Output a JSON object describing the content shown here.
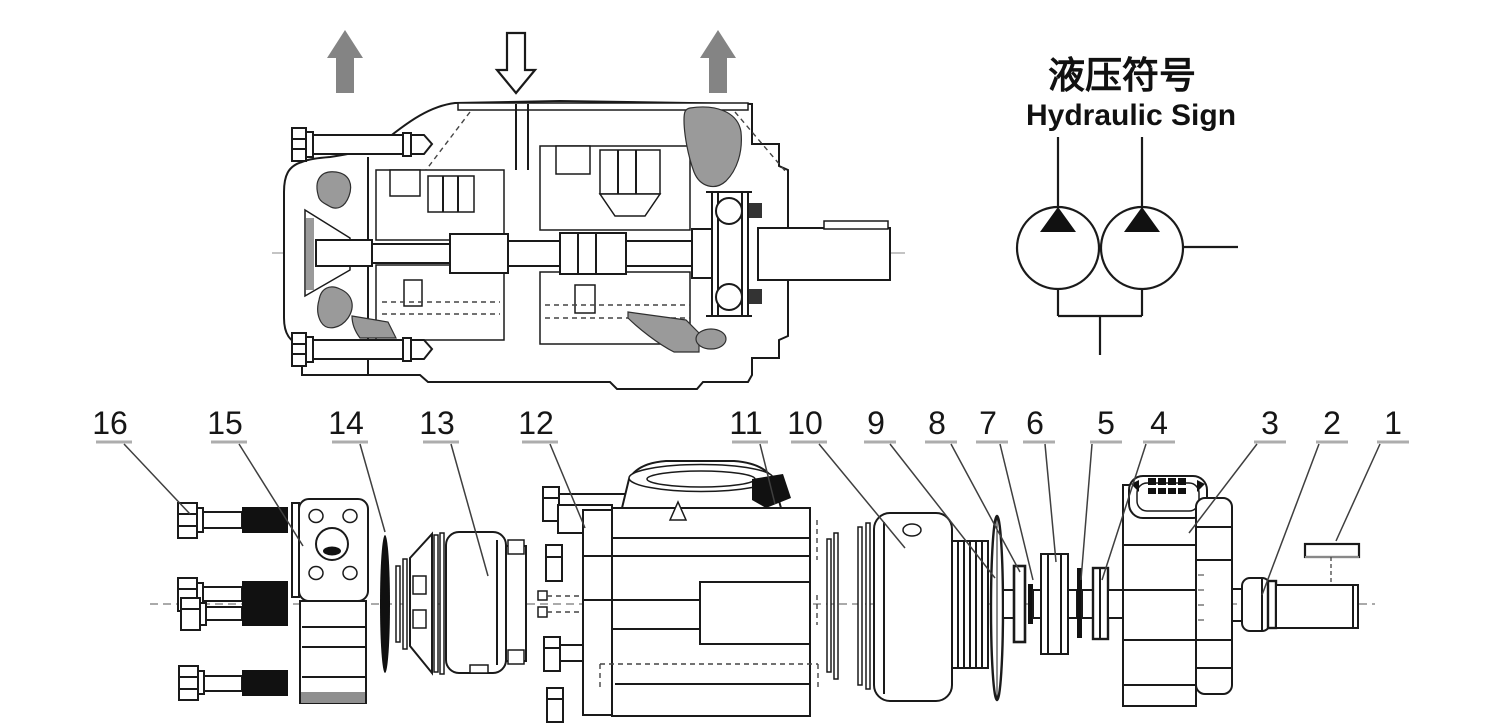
{
  "hydraulic_sign": {
    "title_zh": "液压符号",
    "title_en": "Hydraulic Sign"
  },
  "exploded_view": {
    "labels": [
      {
        "number": "16"
      },
      {
        "number": "15"
      },
      {
        "number": "14"
      },
      {
        "number": "13"
      },
      {
        "number": "12"
      },
      {
        "number": "11"
      },
      {
        "number": "10"
      },
      {
        "number": "9"
      },
      {
        "number": "8"
      },
      {
        "number": "7"
      },
      {
        "number": "6"
      },
      {
        "number": "5"
      },
      {
        "number": "4"
      },
      {
        "number": "3"
      },
      {
        "number": "2"
      },
      {
        "number": "1"
      }
    ]
  },
  "colors": {
    "line": "#1a1a1a",
    "gray_fill": "#9a9a9a",
    "arrow_gray": "#848484",
    "black_fill": "#111111",
    "background": "#ffffff"
  },
  "icons": {
    "up_arrows": "flow-out-arrow",
    "down_arrow": "flow-in-arrow",
    "pump_symbol": "double-pump-circles-with-triangles"
  }
}
